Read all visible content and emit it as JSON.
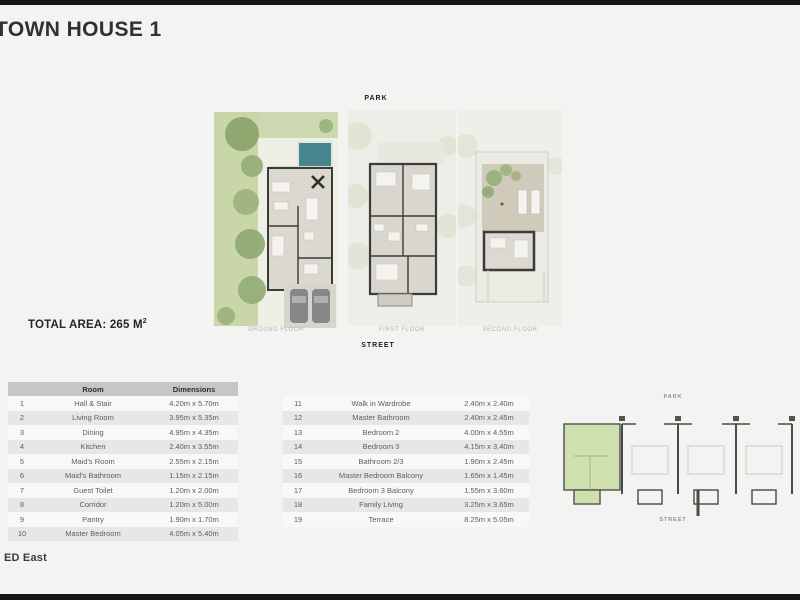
{
  "page": {
    "title": "TOWN HOUSE 1",
    "total_area": "TOTAL AREA: 265 M",
    "total_area_sup": "2",
    "footer_text": "ED East"
  },
  "plans": {
    "park_label": "PARK",
    "street_label": "STREET",
    "floors": [
      {
        "label": "GROUND FLOOR"
      },
      {
        "label": "FIRST FLOOR"
      },
      {
        "label": "SECOND FLOOR"
      }
    ]
  },
  "room_table": {
    "headers": {
      "num": "",
      "room": "Room",
      "dimensions": "Dimensions"
    },
    "left_rows": [
      {
        "num": "1",
        "room": "Hall & Stair",
        "dim": "4.20m x 5.70m"
      },
      {
        "num": "2",
        "room": "Living Room",
        "dim": "3.95m x 5.35m"
      },
      {
        "num": "3",
        "room": "Dining",
        "dim": "4.95m x 4.35m"
      },
      {
        "num": "4",
        "room": "Kitchen",
        "dim": "2.40m x 3.55m"
      },
      {
        "num": "5",
        "room": "Maid's Room",
        "dim": "2.55m x 2.15m"
      },
      {
        "num": "6",
        "room": "Maid's Bathroom",
        "dim": "1.15m x 2.15m"
      },
      {
        "num": "7",
        "room": "Guest Toilet",
        "dim": "1.20m x 2.00m"
      },
      {
        "num": "8",
        "room": "Corridor",
        "dim": "1.20m x 5.00m"
      },
      {
        "num": "9",
        "room": "Pantry",
        "dim": "1.90m x 1.70m"
      },
      {
        "num": "10",
        "room": "Master Bedroom",
        "dim": "4.05m x 5.40m"
      }
    ],
    "right_rows": [
      {
        "num": "11",
        "room": "Walk in Wardrobe",
        "dim": "2.40m x 2.40m"
      },
      {
        "num": "12",
        "room": "Master Bathroom",
        "dim": "2.40m x 2.45m"
      },
      {
        "num": "13",
        "room": "Bedroom 2",
        "dim": "4.00m x 4.55m"
      },
      {
        "num": "14",
        "room": "Bedroom 3",
        "dim": "4.15m x 3.40m"
      },
      {
        "num": "15",
        "room": "Bathroom 2/3",
        "dim": "1.90m x 2.45m"
      },
      {
        "num": "16",
        "room": "Master Bedroom Balcony",
        "dim": "1.65m x 1.45m"
      },
      {
        "num": "17",
        "room": "Bedroom 3 Balcony",
        "dim": "1.55m x 3.60m"
      },
      {
        "num": "18",
        "room": "Family Living",
        "dim": "3.25m x 3.65m"
      },
      {
        "num": "19",
        "room": "Terrace",
        "dim": "8.25m x 5.05m"
      }
    ]
  },
  "site_plan": {
    "park_label": "PARK",
    "street_label": "STREET",
    "highlight_color": "#cde0ad"
  },
  "plan_colors": {
    "garden": "#c8d6a8",
    "pool": "#47858e",
    "walls": "#3b3b3b"
  }
}
